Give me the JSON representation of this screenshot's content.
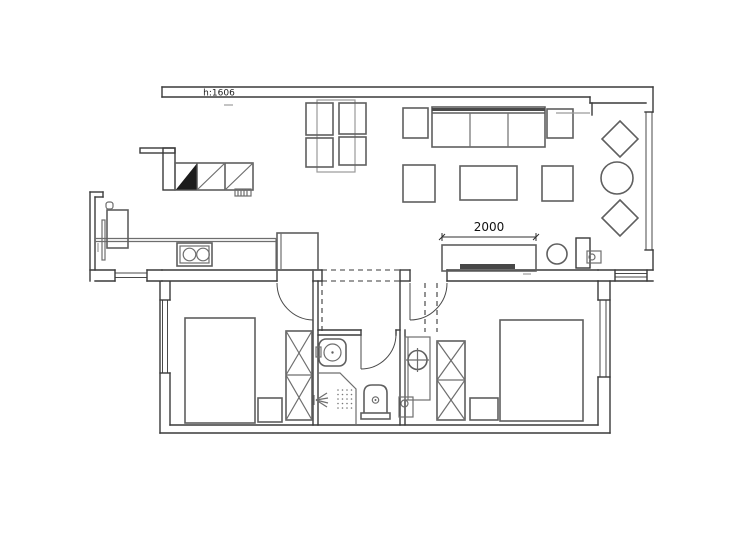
{
  "page": {
    "background": "#ffffff"
  },
  "plan": {
    "beam_label": "h:1606",
    "tv_dimension_label": "2000",
    "colors": {
      "wall_line": "#3a3a3a",
      "furniture_line": "#5f5f5f",
      "light_line": "#9a9a9a",
      "black_fill": "#1c1c1c",
      "background": "#ffffff"
    },
    "elements": [
      "top-beam",
      "balcony-window",
      "balcony-lounge-chairs",
      "balcony-round-table",
      "living-sofa",
      "sofa-side-tables",
      "coffee-table",
      "ottomans",
      "dining-table-set",
      "tv-cabinet",
      "tv",
      "plant",
      "kitchen-counter",
      "stove",
      "fridge",
      "wall-cabinets",
      "range-hood-vent",
      "entry-cabinet",
      "entry-dashed-zone",
      "bedroom-1-bed",
      "bedroom-1-nightstand",
      "bedroom-1-wardrobe",
      "bedroom-1-door",
      "bedroom-2-bed",
      "bedroom-2-nightstand",
      "bedroom-2-wardrobe",
      "bedroom-2-door",
      "bathroom-door",
      "bathroom-washbasin",
      "shower-area",
      "toilet",
      "wash-basin-niche",
      "windows",
      "floor-drain-box"
    ]
  }
}
